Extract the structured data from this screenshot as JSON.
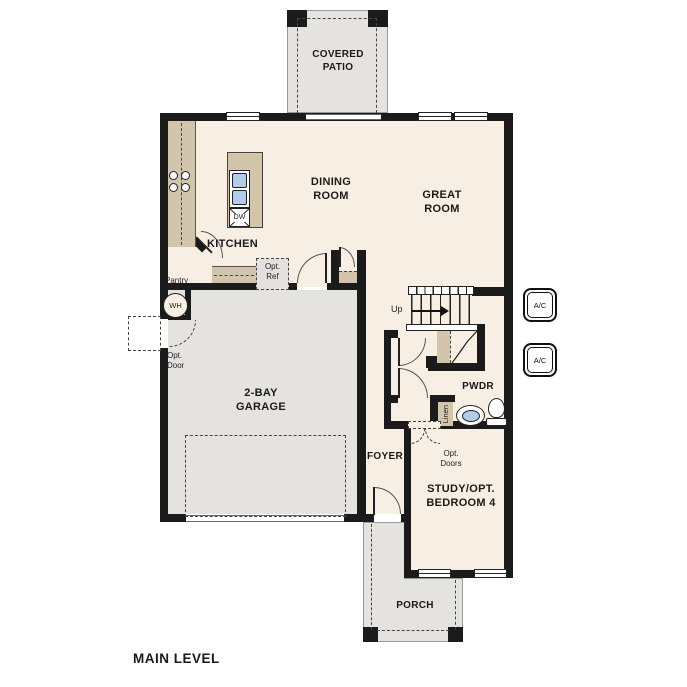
{
  "title": "MAIN LEVEL",
  "rooms": {
    "covered_patio": "COVERED PATIO",
    "dining_room": "DINING ROOM",
    "great_room": "GREAT ROOM",
    "kitchen": "KITCHEN",
    "garage": "2-BAY GARAGE",
    "foyer": "FOYER",
    "pwdr": "PWDR",
    "study": "STUDY/OPT. BEDROOM 4",
    "porch": "PORCH"
  },
  "labels": {
    "pantry": "Pantry",
    "opt_ref": "Opt. Ref",
    "opt_door": "Opt. Door",
    "opt_doors": "Opt. Doors",
    "up": "Up",
    "wh": "WH",
    "dw": "DW",
    "linen": "Linen",
    "ac": "A/C"
  },
  "colors": {
    "floor": "#f7efe3",
    "outdoor": "#e4e3e0",
    "counter": "#d2c5ab",
    "wall": "#1b1b1b",
    "sink_blue": "#b3cde9"
  }
}
